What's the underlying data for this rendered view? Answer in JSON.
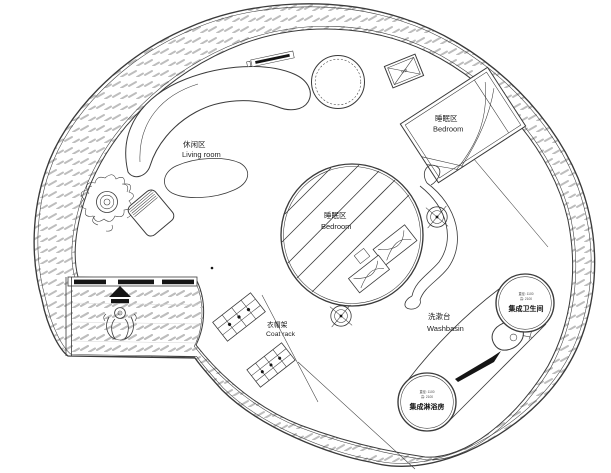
{
  "labels": {
    "living_room": {
      "zh": "休闲区",
      "en": "Living room"
    },
    "bedroom_upper": {
      "zh": "睡眠区",
      "en": "Bedroom"
    },
    "bedroom_center": {
      "zh": "睡眠区",
      "en": "Bedroom"
    },
    "coat_rack": {
      "zh": "衣帽架",
      "en": "Coat rack"
    },
    "washbasin": {
      "zh": "洗漱台",
      "en": "Washbasin"
    },
    "bathroom_pod": {
      "name": "集成卫生间",
      "spec_line1": "直径: 1100",
      "spec_line2": "高: 2100"
    },
    "shower_pod": {
      "name": "集成淋浴房",
      "spec_line1": "直径: 1100",
      "spec_line2": "高: 2100"
    },
    "ac_unit": {
      "name": "空调"
    }
  },
  "colors": {
    "line": "#3a3a3a",
    "hatch": "#bdbdbd",
    "background": "#ffffff",
    "fill-black": "#151515"
  }
}
